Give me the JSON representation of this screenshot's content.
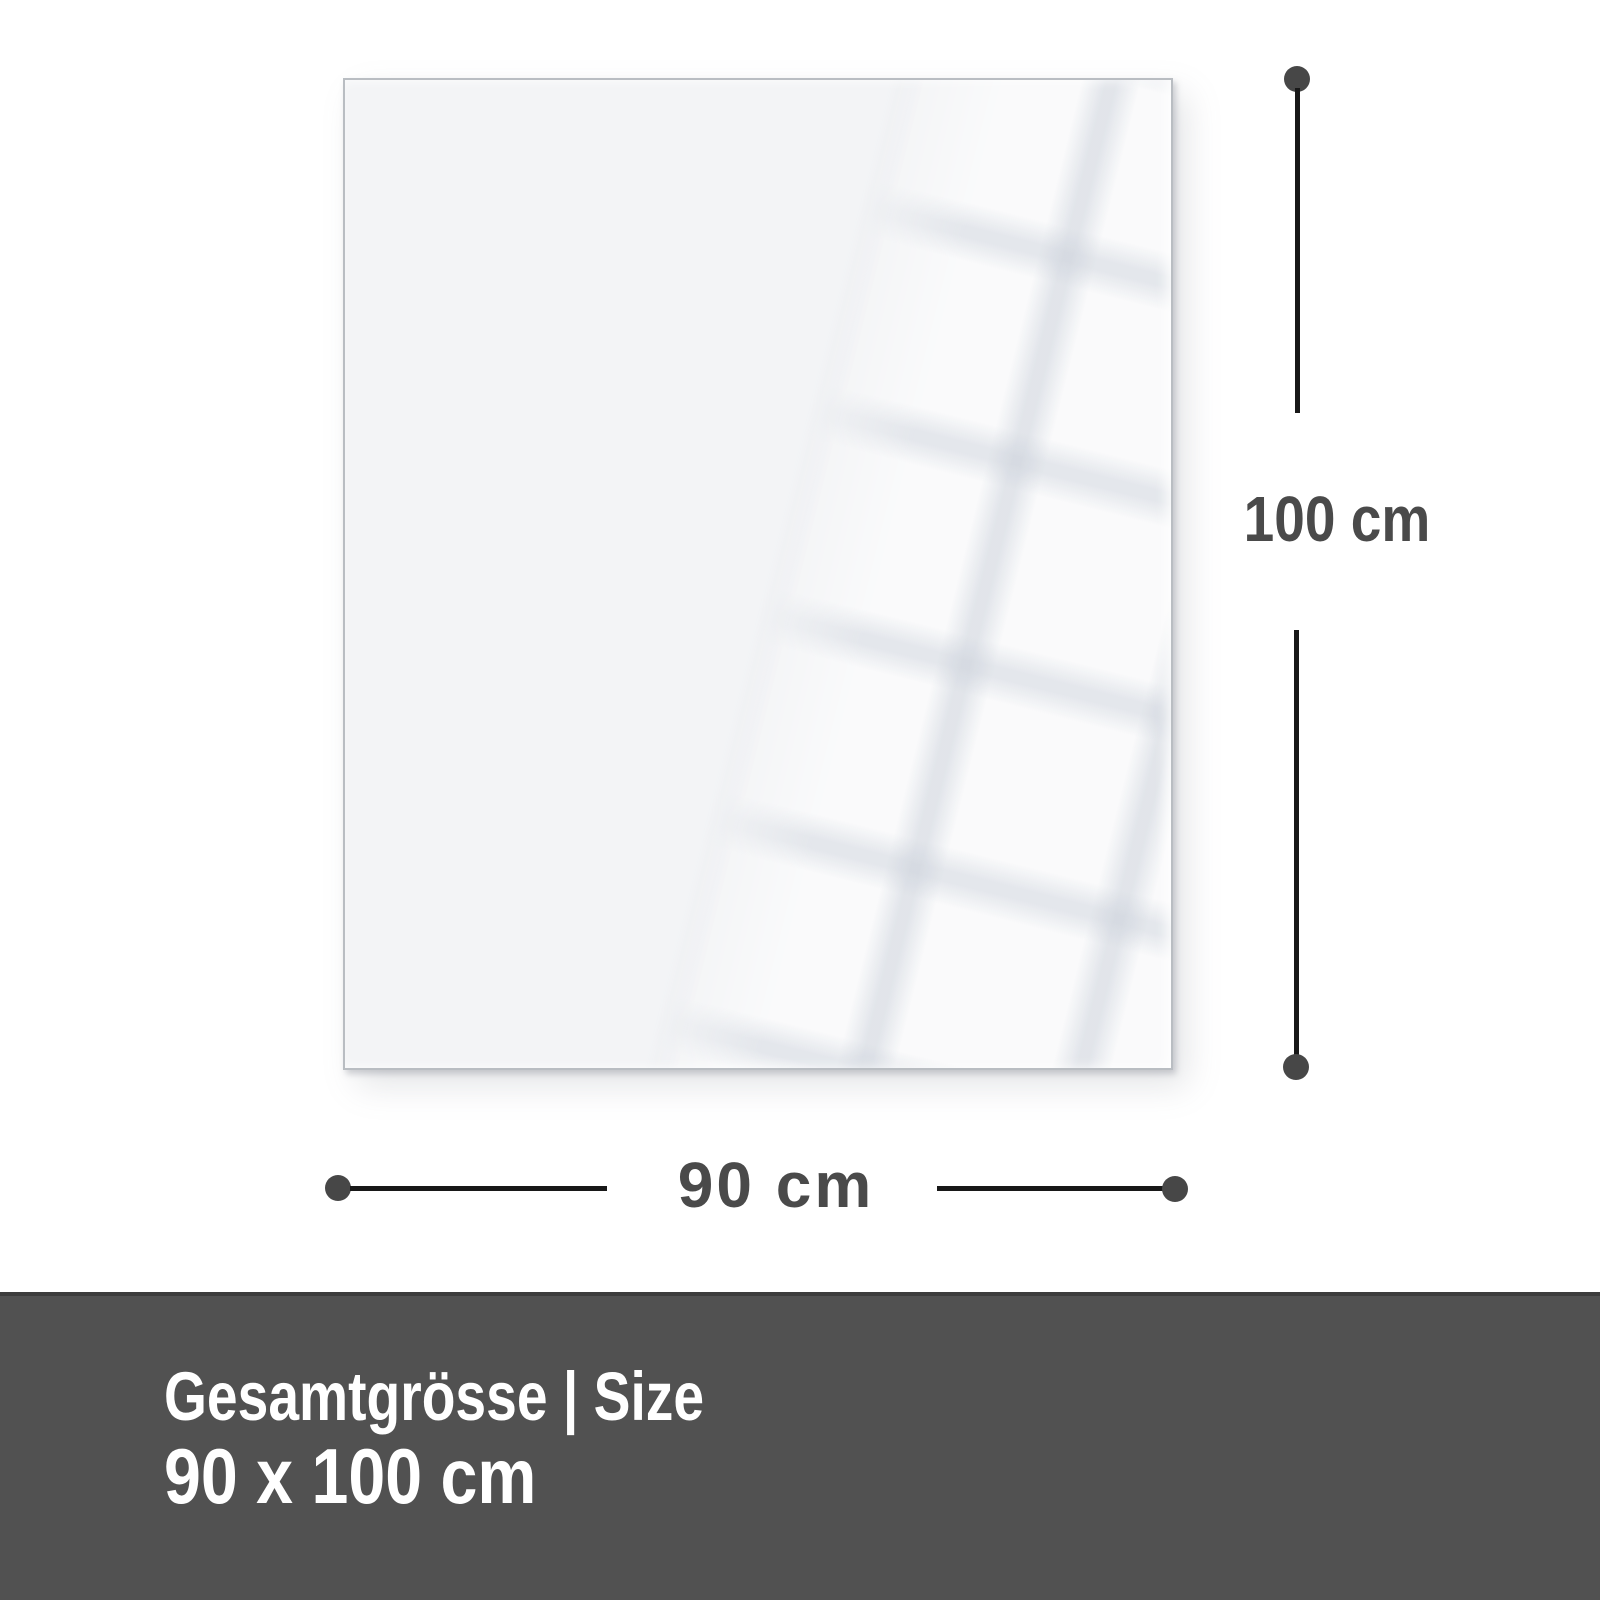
{
  "diagram": {
    "height_label": "100 cm",
    "width_label": "90 cm"
  },
  "footer": {
    "title": "Gesamtgrösse | Size",
    "size": "90 x 100 cm"
  },
  "colors": {
    "background": "#ffffff",
    "panel_fill": "#f3f4f6",
    "panel_border": "#b9bdc2",
    "dimension_line": "#181818",
    "dimension_dot": "#474747",
    "label_text": "#4a4a4a",
    "footer_background": "#515151",
    "footer_border_top": "#3c3c3c",
    "footer_text": "#ffffff"
  }
}
